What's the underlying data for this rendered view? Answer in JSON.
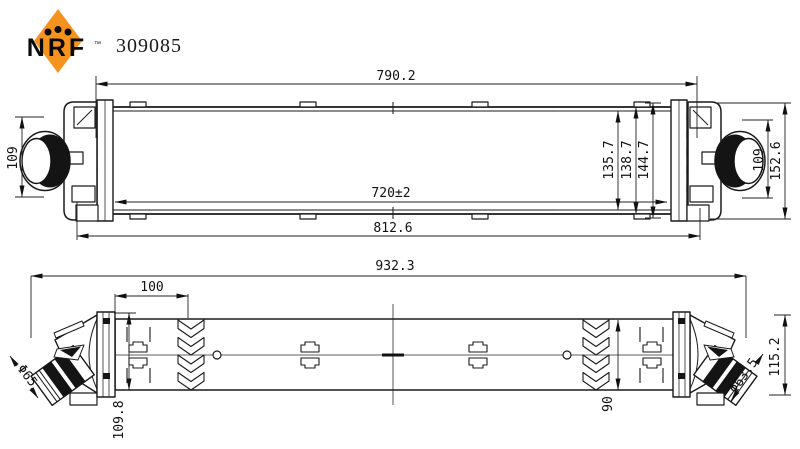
{
  "header": {
    "brand": "NRF",
    "trademark": "™",
    "part_number": "309085",
    "brand_color": "#F6921E"
  },
  "top_view": {
    "dims": {
      "core_width_top": "790.2",
      "core_width_between_plates": "720±2",
      "overall_width": "812.6",
      "core_height_inner": "135.7",
      "core_height": "138.7",
      "core_height_outer": "144.7",
      "left_port_height": "109",
      "right_port_height": "109",
      "overall_height": "152.6"
    }
  },
  "bottom_view": {
    "dims": {
      "overall_length": "932.3",
      "mount_offset": "100",
      "left_depth": "109.8",
      "core_depth": "90",
      "right_depth": "115.2",
      "left_hose_diameter": "Φ65",
      "right_hose_diameter": "Φ63.5"
    }
  }
}
